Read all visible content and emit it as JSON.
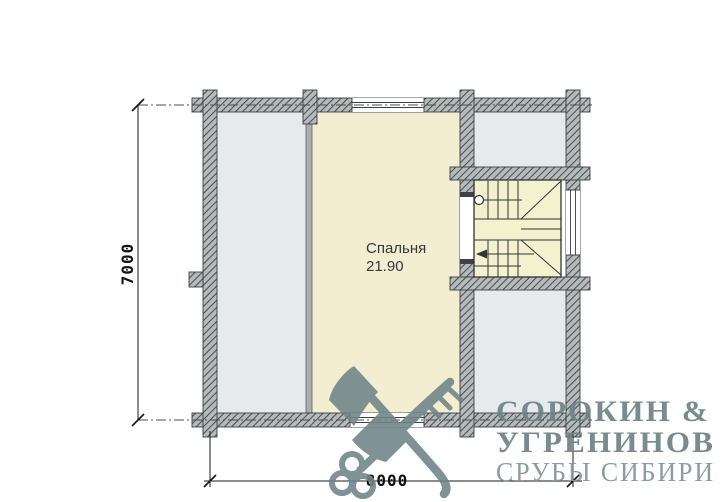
{
  "floor_plan": {
    "room": {
      "name": "Спальня",
      "area": "21.90"
    },
    "dim_vertical": "7000",
    "dim_horizontal": "8000"
  },
  "logo": {
    "line1": "СОРОКИН &",
    "line2": "УГРЕНИНОВ",
    "line3": "СРУБЫ СИБИРИ",
    "color": "#6e8487",
    "color_light": "#84969a"
  },
  "colors": {
    "wall_fill": "#b5babb",
    "wall_hatch": "#4a5053",
    "room_default": "#e7eaea",
    "bedroom": "#f3edd1",
    "stairs": "#f4f1cf",
    "partition": "#a9afb1",
    "background": "#ffffff"
  }
}
